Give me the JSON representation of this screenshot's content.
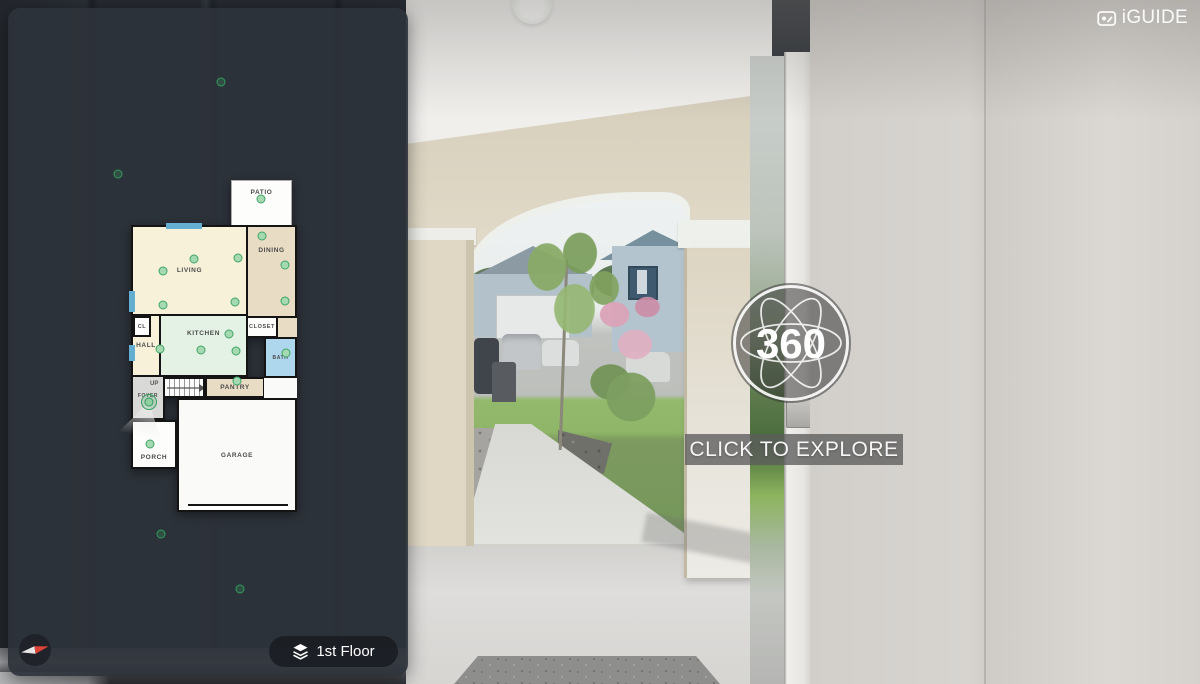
{
  "brand": {
    "logo_text": "iGUIDE"
  },
  "viewer": {
    "badge_label": "360",
    "cta_label": "CLICK TO EXPLORE"
  },
  "floor_selector": {
    "label": "1st Floor"
  },
  "floorplan": {
    "rooms": [
      {
        "label": "PATIO",
        "fill": "#fdfdfc"
      },
      {
        "label": "LIVING",
        "fill": "#f8f1d9"
      },
      {
        "label": "DINING",
        "fill": "#e9dcc4"
      },
      {
        "label": "CL",
        "fill": "#ffffff"
      },
      {
        "label": "KITCHEN",
        "fill": "#e4f2e5"
      },
      {
        "label": "CLOSET",
        "fill": "#fdfdfc"
      },
      {
        "label": "HALL",
        "fill": "#f8f1d9"
      },
      {
        "label": "BATH",
        "fill": "#aed7ee"
      },
      {
        "label": "PANTRY",
        "fill": "#e9dcc4"
      },
      {
        "label": "FOYER",
        "fill": "#d9d9d7"
      },
      {
        "label": "UP",
        "fill": "#fbfbfb"
      },
      {
        "label": "PORCH",
        "fill": "#fdfdfc"
      },
      {
        "label": "GARAGE",
        "fill": "#fafaf9"
      }
    ],
    "markers": {
      "panoramas": [
        [
          261,
          199
        ],
        [
          163,
          271
        ],
        [
          194,
          259
        ],
        [
          238,
          258
        ],
        [
          163,
          305
        ],
        [
          235,
          302
        ],
        [
          262,
          236
        ],
        [
          285,
          265
        ],
        [
          285,
          301
        ],
        [
          229,
          334
        ],
        [
          201,
          350
        ],
        [
          236,
          351
        ],
        [
          160,
          349
        ],
        [
          286,
          353
        ],
        [
          237,
          381
        ],
        [
          150,
          444
        ]
      ],
      "current": [
        149,
        402
      ],
      "outdoor": [
        [
          221,
          82
        ],
        [
          118,
          174
        ],
        [
          161,
          534
        ],
        [
          240,
          589
        ]
      ]
    },
    "colors": {
      "marker_green": "#3fa565",
      "marker_fill": "#a5d9b2",
      "window_blue": "#64aed2",
      "wall_black": "#141414"
    }
  },
  "photo_colors": {
    "stucco_beige": "#e0d8c5",
    "interior_wall_gray": "#d5d2ce",
    "panel_dark": "#2d333a"
  }
}
